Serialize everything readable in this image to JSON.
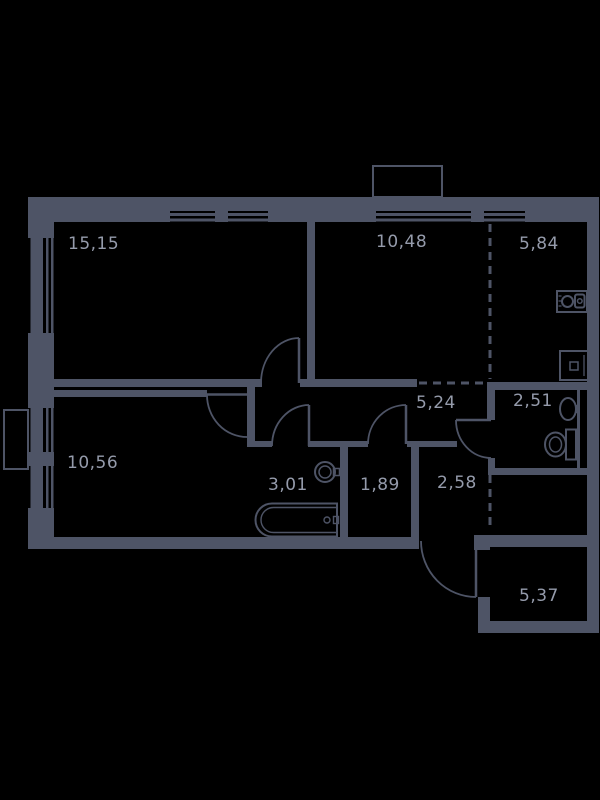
{
  "floorplan": {
    "title": "apartment-floor-plan",
    "colors": {
      "background": "#000000",
      "wall": "#4e5466",
      "label": "#959bab"
    },
    "rooms": [
      {
        "id": "room1",
        "area_label": "15,15"
      },
      {
        "id": "room2",
        "area_label": "10,48"
      },
      {
        "id": "room3",
        "area_label": "5,84"
      },
      {
        "id": "room4",
        "area_label": "5,24"
      },
      {
        "id": "room5",
        "area_label": "2,51"
      },
      {
        "id": "room6",
        "area_label": "10,56"
      },
      {
        "id": "room7",
        "area_label": "3,01"
      },
      {
        "id": "room8",
        "area_label": "1,89"
      },
      {
        "id": "room9",
        "area_label": "2,58"
      },
      {
        "id": "room10",
        "area_label": "5,37"
      }
    ]
  }
}
